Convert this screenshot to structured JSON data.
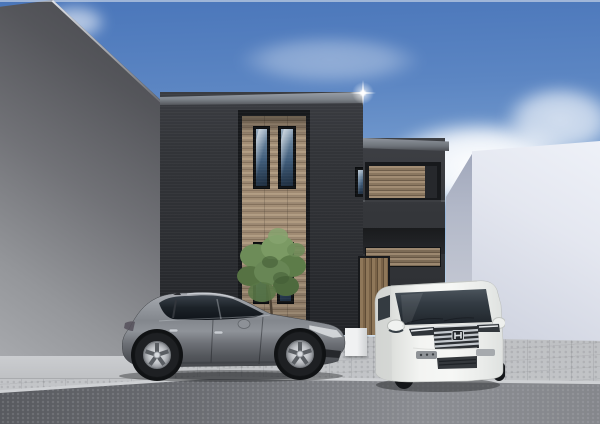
{
  "scene": {
    "description": "Architectural 3D rendering of a modern flat-roof charcoal house with a recessed wood-slat bay, parked silver hatchback and white minivan, between a gray wall and a white building under a blue sky",
    "sky": {
      "label": "blue sky with scattered white clouds"
    },
    "buildings": {
      "left_neighbor": {
        "label": "gray neighboring building wall in shade"
      },
      "right_neighbor": {
        "label": "white neighboring building"
      },
      "main_house": {
        "label": "modern two-story charcoal house",
        "features": [
          "flat parapet roof with light metal coping",
          "recessed vertical bay clad in wood slats",
          "two slim upper windows and two slim lower windows",
          "second-floor wood-louver balcony band",
          "dark balcony parapet",
          "vertical wood-slat entry door",
          "sun glint on the parapet corner",
          "small tree planted at the base"
        ]
      }
    },
    "vehicles": {
      "hatchback": {
        "label": "silver hatchback parked side-on facing right",
        "emblem": ""
      },
      "minivan": {
        "label": "white minivan facing the street",
        "emblem": "H"
      }
    },
    "ground": {
      "label": "concrete paver driveway, sidewalk and asphalt street"
    },
    "palette": {
      "sky-top": "#4a76ba",
      "sky-mid": "#7da3d2",
      "sky-horizon": "#d5e2ef",
      "cloud": "#ffffff",
      "left-wall-dark": "#45464b",
      "left-wall-light": "#a7a9ad",
      "house-wall": "#2e3034",
      "house-wall-light": "#3e4045",
      "fascia-light": "#9aa0a8",
      "fascia-dark": "#54575c",
      "frame": "#17191c",
      "wood": "#a08b73",
      "wood-dark": "#84715c",
      "door-wood": "#7a6348",
      "glass": "#3f5c7a",
      "glass-dark": "#1d2c3d",
      "right-wall-front": "#e4e7f0",
      "right-wall-side": "#b2b8c8",
      "pavement": "#b9bbbe",
      "sidewalk": "#cbcdd0",
      "curb": "#cfd1d4",
      "road": "#8b8d92",
      "road-dark": "#55575c",
      "car-body": "#84888e",
      "car-glass": "#161a1f",
      "rim": "#c2c5c9",
      "van-body": "#f3f4f2",
      "van-shade": "#d3d6d3",
      "van-glass": "#333b43",
      "chrome": "#c6cbd0",
      "foliage": "#688655",
      "foliage-dark": "#4e6a3e",
      "trunk": "#4d4134",
      "shadow": "#2b2d30",
      "glint": "#ffffff"
    }
  }
}
